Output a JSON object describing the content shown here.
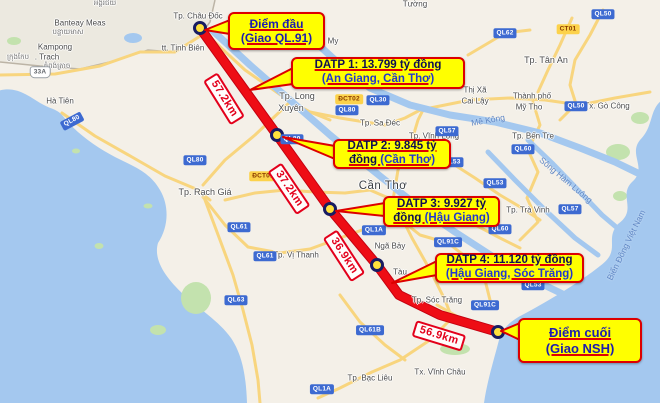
{
  "map": {
    "colors": {
      "sea": "#a4c8ef",
      "land": "#f4f0e8",
      "cambodia": "#eae7de",
      "border": "#bcb4a6",
      "road_yellow": "#f8d57e",
      "river": "#a4c8ef",
      "green": "#c3e2ae",
      "route_red": "#ee0d15",
      "route_edge": "#c40010",
      "waypoint_fill": "#ffe23c",
      "waypoint_ring": "#181c62",
      "callout_bg": "#ffff00",
      "callout_border": "#dd0000",
      "distance_red": "#e3001b"
    },
    "route_points": "200,28 277,135 330,209 377,265 399,295 440,315 498,332",
    "waypoints": [
      {
        "x": 200,
        "y": 28
      },
      {
        "x": 277,
        "y": 135
      },
      {
        "x": 330,
        "y": 209
      },
      {
        "x": 377,
        "y": 265
      },
      {
        "x": 498,
        "y": 332
      }
    ],
    "distance_labels": [
      {
        "t": "57.2km",
        "x": 224,
        "y": 99,
        "rot": 58
      },
      {
        "t": "37.2km",
        "x": 289,
        "y": 189,
        "rot": 56
      },
      {
        "t": "36.9km",
        "x": 344,
        "y": 256,
        "rot": 57
      },
      {
        "t": "56.9km",
        "x": 439,
        "y": 336,
        "rot": 17
      }
    ],
    "place_labels": [
      {
        "t": "Banteay Meas",
        "x": 80,
        "y": 23,
        "s": "sm"
      },
      {
        "t": "បន្ទាយមាស",
        "x": 68,
        "y": 33,
        "s": "kh"
      },
      {
        "t": "Kampong",
        "x": 55,
        "y": 47,
        "s": "sm"
      },
      {
        "t": ". Trach",
        "x": 47,
        "y": 57,
        "s": "sm"
      },
      {
        "t": "កំពង់ត្រាច",
        "x": 57,
        "y": 67,
        "s": "kh"
      },
      {
        "t": "ក្រុងកែប",
        "x": 18,
        "y": 58,
        "s": "kh"
      },
      {
        "t": "អង្គរជ័យ",
        "x": 105,
        "y": 4,
        "s": "kh"
      },
      {
        "t": "Hà Tiên",
        "x": 60,
        "y": 101,
        "s": "sm"
      },
      {
        "t": "tt. Tịnh Biên",
        "x": 183,
        "y": 48,
        "s": "sm"
      },
      {
        "t": "Tp. Châu Đốc",
        "x": 198,
        "y": 16,
        "s": "sm"
      },
      {
        "t": "My",
        "x": 333,
        "y": 41,
        "s": "sm"
      },
      {
        "t": "Tường",
        "x": 415,
        "y": 4,
        "s": "sm"
      },
      {
        "t": "Tp. Long",
        "x": 297,
        "y": 96,
        "s": "md"
      },
      {
        "t": "Xuyên",
        "x": 291,
        "y": 108,
        "s": "md"
      },
      {
        "t": "Tp. Sa Đéc",
        "x": 380,
        "y": 123,
        "s": "sm"
      },
      {
        "t": "Tp. Vĩnh Long",
        "x": 434,
        "y": 136,
        "s": "sm"
      },
      {
        "t": "Thị Xã",
        "x": 475,
        "y": 90,
        "s": "sm"
      },
      {
        "t": "Cai Lậy",
        "x": 475,
        "y": 101,
        "s": "sm"
      },
      {
        "t": "Tp. Tân An",
        "x": 546,
        "y": 60,
        "s": "md"
      },
      {
        "t": "Thành phố",
        "x": 532,
        "y": 96,
        "s": "sm"
      },
      {
        "t": "Mỹ Tho",
        "x": 529,
        "y": 107,
        "s": "sm"
      },
      {
        "t": "Tx. Gò Công",
        "x": 607,
        "y": 106,
        "s": "sm"
      },
      {
        "t": "Tp. Bến Tre",
        "x": 533,
        "y": 136,
        "s": "sm"
      },
      {
        "t": "Tp. Trà Vinh",
        "x": 528,
        "y": 210,
        "s": "sm"
      },
      {
        "t": "Cần Thơ",
        "x": 383,
        "y": 186,
        "s": "lg"
      },
      {
        "t": "Ngã Bảy",
        "x": 390,
        "y": 246,
        "s": "sm"
      },
      {
        "t": "Tàu",
        "x": 400,
        "y": 272,
        "s": "sm"
      },
      {
        "t": "Tp. Vị Thanh",
        "x": 296,
        "y": 255,
        "s": "sm"
      },
      {
        "t": "Tp. Sóc Trăng",
        "x": 437,
        "y": 300,
        "s": "sm"
      },
      {
        "t": "Tp. Bạc Liêu",
        "x": 370,
        "y": 378,
        "s": "sm"
      },
      {
        "t": "Tx. Vĩnh Châu",
        "x": 440,
        "y": 372,
        "s": "sm"
      },
      {
        "t": "Tp. Rạch Giá",
        "x": 205,
        "y": 192,
        "s": "md"
      }
    ],
    "water_labels": [
      {
        "t": "Mê Kông",
        "x": 488,
        "y": 120,
        "rot": -10
      },
      {
        "t": "Sông Hàm Luông",
        "x": 566,
        "y": 180,
        "rot": 40
      },
      {
        "t": "Biển Đông Việt Nam",
        "x": 626,
        "y": 245,
        "rot": -64
      }
    ],
    "road_badges": [
      {
        "t": "QL80",
        "x": 195,
        "y": 160
      },
      {
        "t": "QL80",
        "x": 72,
        "y": 121,
        "rot": -28
      },
      {
        "t": "33A",
        "x": 40,
        "y": 72,
        "st": "shield"
      },
      {
        "t": "ĐCT02",
        "x": 349,
        "y": 99,
        "st": "yellow"
      },
      {
        "t": "QL30",
        "x": 378,
        "y": 100
      },
      {
        "t": "QL80",
        "x": 347,
        "y": 110
      },
      {
        "t": "QL80",
        "x": 292,
        "y": 139
      },
      {
        "t": "ĐCT01",
        "x": 263,
        "y": 176,
        "st": "yellow"
      },
      {
        "t": "QL61",
        "x": 239,
        "y": 227
      },
      {
        "t": "QL61",
        "x": 265,
        "y": 256
      },
      {
        "t": "QL63",
        "x": 236,
        "y": 300
      },
      {
        "t": "QL61B",
        "x": 370,
        "y": 330
      },
      {
        "t": "QL1A",
        "x": 322,
        "y": 389
      },
      {
        "t": "QL1A",
        "x": 374,
        "y": 230
      },
      {
        "t": "QL91C",
        "x": 448,
        "y": 242
      },
      {
        "t": "QL91C",
        "x": 485,
        "y": 305
      },
      {
        "t": "QL53",
        "x": 452,
        "y": 162
      },
      {
        "t": "QL53",
        "x": 495,
        "y": 183
      },
      {
        "t": "QL53",
        "x": 533,
        "y": 285
      },
      {
        "t": "QL60",
        "x": 523,
        "y": 149
      },
      {
        "t": "QL60",
        "x": 500,
        "y": 229
      },
      {
        "t": "QL57",
        "x": 570,
        "y": 209
      },
      {
        "t": "QL57",
        "x": 447,
        "y": 131
      },
      {
        "t": "QL62",
        "x": 505,
        "y": 33
      },
      {
        "t": "QL50",
        "x": 603,
        "y": 14
      },
      {
        "t": "QL50",
        "x": 576,
        "y": 106
      },
      {
        "t": "CT01",
        "x": 568,
        "y": 29,
        "st": "yellow"
      }
    ],
    "roads": [
      "0,75 55,74 100,66 140,52 175,52 205,33",
      "205,33 245,70 285,98 310,112 330,120",
      "288,104 255,135 225,160 203,185",
      "62,113 95,136 132,157 165,176 196,189 210,200",
      "203,197 225,225 248,247 280,253 310,249 340,238 362,230",
      "393,200 412,238 430,270 445,300 452,318",
      "452,318 430,340 400,360 372,372 340,388 318,398",
      "393,200 398,170 412,140 418,120 424,108",
      "205,200 220,240 233,275 243,310 252,345 258,380 260,403",
      "430,108 470,100 510,98 545,100 580,105 615,98 650,92",
      "533,102 540,125 528,150 538,172 527,198 538,222 520,240",
      "572,18 560,45 548,70 538,92",
      "468,55 490,42 505,33 530,30",
      "603,10 590,35 575,60 570,85 576,104 560,120",
      "450,162 475,178 500,195 522,208 540,220",
      "440,205 470,222 500,238 520,248",
      "395,215 420,235 448,243 470,260 485,280 490,300",
      "437,305 460,318 480,330",
      "340,295 360,322 385,345 405,360",
      "310,112 340,118 365,122 385,125 405,118 424,108",
      "225,200 255,193 285,190 315,192 345,193 370,190 393,200"
    ],
    "rivers": [
      {
        "p": "212,30 250,65 290,100 330,135 370,168 395,188 420,208 455,232 495,258 540,283 575,300 600,310",
        "w": 7
      },
      {
        "p": "300,28 335,60 370,88 410,105 450,115 495,122 540,133 580,148 615,162 648,178",
        "w": 7
      },
      {
        "p": "528,140 552,163 578,190 602,215 622,232",
        "w": 5
      },
      {
        "p": "488,152 515,180 545,210 575,238 598,255",
        "w": 5
      }
    ],
    "green_patches": [
      {
        "x": 618,
        "y": 152,
        "w": 24,
        "h": 16
      },
      {
        "x": 640,
        "y": 118,
        "w": 18,
        "h": 12
      },
      {
        "x": 196,
        "y": 298,
        "w": 30,
        "h": 32
      },
      {
        "x": 158,
        "y": 330,
        "w": 16,
        "h": 10
      },
      {
        "x": 76,
        "y": 151,
        "w": 8,
        "h": 5
      },
      {
        "x": 148,
        "y": 206,
        "w": 9,
        "h": 5
      },
      {
        "x": 99,
        "y": 246,
        "w": 9,
        "h": 6
      },
      {
        "x": 455,
        "y": 349,
        "w": 30,
        "h": 12
      },
      {
        "x": 14,
        "y": 41,
        "w": 14,
        "h": 8
      },
      {
        "x": 620,
        "y": 196,
        "w": 14,
        "h": 10
      }
    ]
  },
  "callouts": {
    "diem_dau": {
      "line1": "Điểm đầu",
      "line2": "(Giao QL.91)"
    },
    "datp1": {
      "line1": "DATP 1: 13.799 tỷ đồng",
      "line2_black": "",
      "line2_blue": "(An Giang, Cần Thơ)"
    },
    "datp2": {
      "line1": "DATP 2: 9.845 tỷ",
      "line2_black": "đồng ",
      "line2_blue": "(Cần Thơ)"
    },
    "datp3": {
      "line1": "DATP 3: 9.927 tỷ",
      "line2_black": "đồng ",
      "line2_blue": "(Hậu Giang)"
    },
    "datp4": {
      "line1": "DATP 4: 11.120 tỷ đồng",
      "line2_black": "",
      "line2_blue": "(Hậu Giang, Sóc Trăng)"
    },
    "diem_cuoi": {
      "line1": "Điểm cuối",
      "line2": "(Giao NSH)"
    }
  }
}
